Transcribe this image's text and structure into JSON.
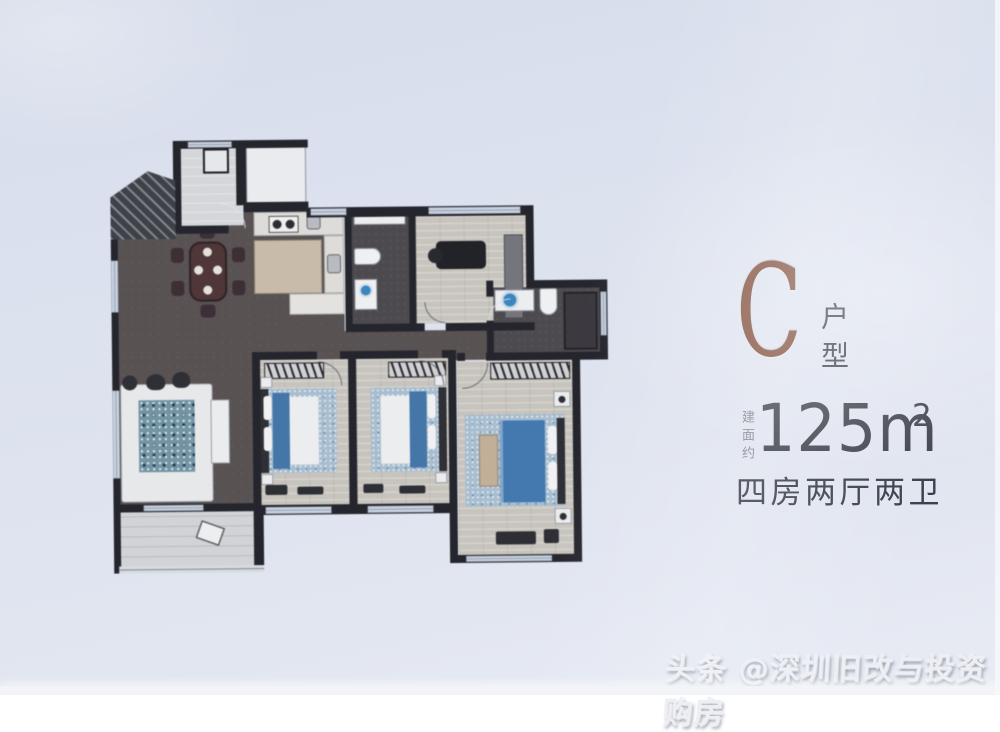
{
  "info_panel": {
    "unit_letter": "C",
    "unit_type_label": "户型",
    "area_prefix": "建面约",
    "area_value": "125m",
    "area_superscript": "2",
    "layout_description": "四房两厅两卫"
  },
  "watermark": {
    "text": "头条 @深圳旧改与投资购房"
  },
  "floor_plan": {
    "description": "apartment-floor-plan",
    "rooms": [
      "entry",
      "dining-room",
      "kitchen",
      "bathroom-1",
      "study",
      "bathroom-2",
      "living-room",
      "bedroom-1",
      "bedroom-2",
      "master-bedroom",
      "balcony",
      "hallway"
    ]
  },
  "colors": {
    "accent_brown": "#7e4b37",
    "title_gray": "#3f424b",
    "label_gray": "#84878f",
    "dark_text": "#3b404c",
    "watermark_color": "#edeff4",
    "wall": "#22232b",
    "floor_dark": "#575052",
    "bath_floor": "#4b484e",
    "wood": "#cac6bf",
    "light_floor": "#d7d9dd",
    "balcony": "#d4d6d9",
    "window": "#ccd6e4",
    "bed_blue": "#3e76ae",
    "master_blue": "#3e79b6",
    "speckle_base": "#a7c0d4",
    "duvet": "#eef0f2",
    "island": "#cbbda9",
    "bench_tan": "#c6b096",
    "plant": "#6f95a8",
    "white_furn": "#edeff1",
    "table_brown": "#4f3334"
  }
}
